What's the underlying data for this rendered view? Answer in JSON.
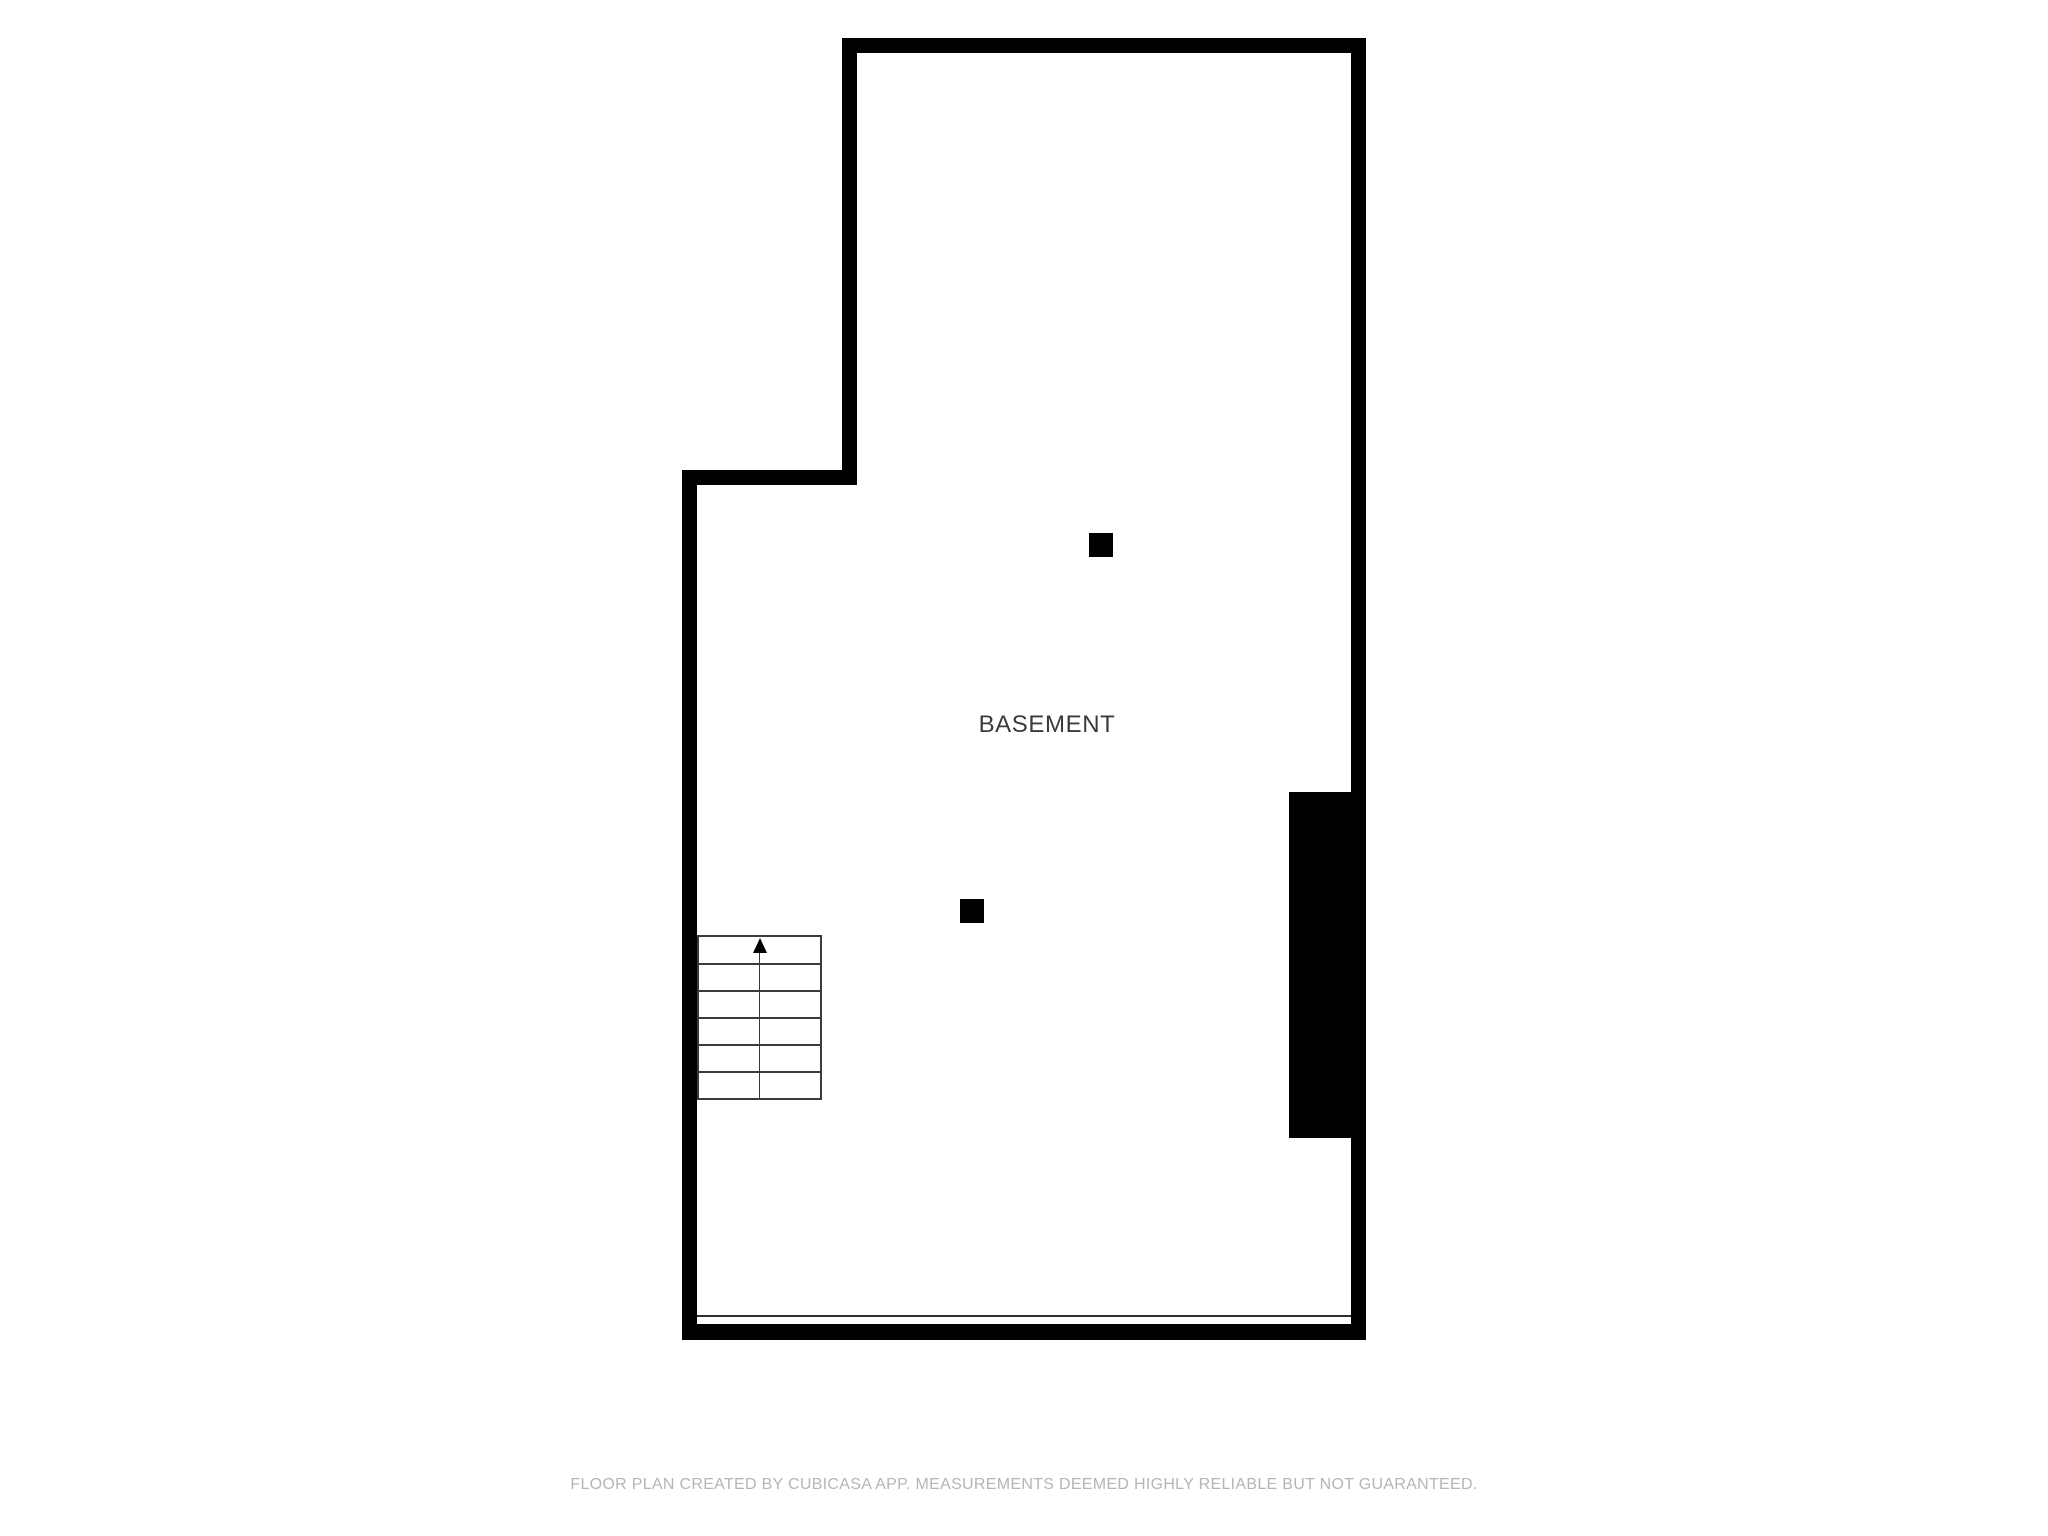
{
  "floor_plan": {
    "room_label": "BASEMENT",
    "stairs": {
      "name": "staircase",
      "direction": "up",
      "treads": 6
    },
    "columns_count": 2,
    "footer_disclaimer": "FLOOR PLAN CREATED BY CUBICASA APP. MEASUREMENTS DEEMED HIGHLY RELIABLE BUT NOT GUARANTEED."
  },
  "colors": {
    "background": "#ffffff",
    "wall": "#000000",
    "stair_line": "#3a3a3a",
    "room_label_text": "#3b3b3b",
    "footer_text": "#b5b5b5",
    "opening_line": "#2f2f2f"
  }
}
